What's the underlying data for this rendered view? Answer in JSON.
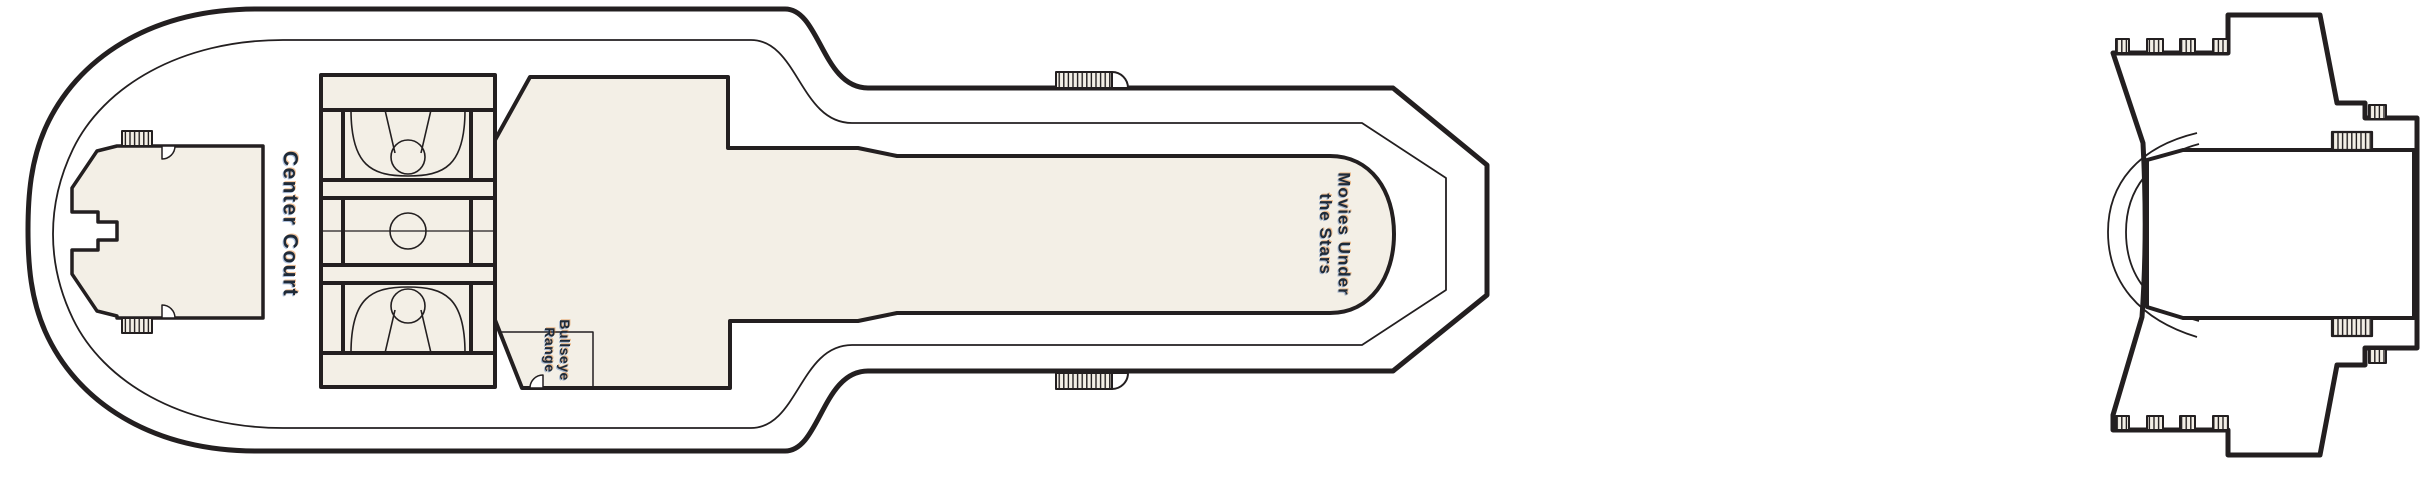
{
  "colors": {
    "outline": "#231f20",
    "deck_fill": "#f3efe6",
    "background": "#ffffff",
    "label_text": "#1e2a38"
  },
  "deck_plan": {
    "forward_section": {
      "center_court_label": "Center Court",
      "bullseye_range_label": {
        "line1": "Bullseye",
        "line2": "Range"
      },
      "movies_label": {
        "line1": "Movies Under",
        "line2": "the Stars"
      }
    }
  }
}
